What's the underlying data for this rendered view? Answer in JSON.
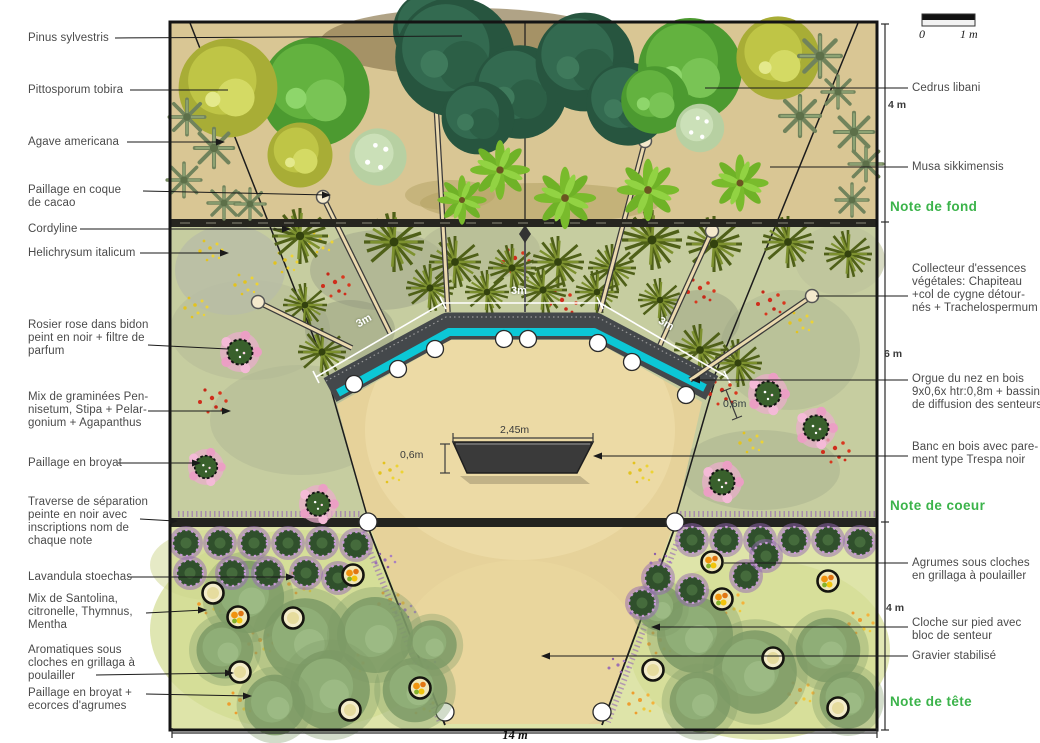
{
  "labels_left": [
    {
      "text": "Pinus sylvestris"
    },
    {
      "text": "Pittosporum tobira"
    },
    {
      "text": "Agave americana"
    },
    {
      "text": "Paillage en coque\nde cacao"
    },
    {
      "text": "Cordyline"
    },
    {
      "text": "Helichrysum italicum"
    },
    {
      "text": "Rosier rose dans bidon\npeint en noir + filtre de\nparfum"
    },
    {
      "text": "Mix de graminées Pen-\nnisetum, Stipa + Pelar-\ngonium + Agapanthus"
    },
    {
      "text": "Paillage en broyat"
    },
    {
      "text": "Traverse de séparation\npeinte en noir avec\ninscriptions nom de\nchaque note"
    },
    {
      "text": "Lavandula stoechas"
    },
    {
      "text": "Mix de Santolina,\ncitronelle, Thymnus,\nMentha"
    },
    {
      "text": "Aromatiques sous\ncloches en grillaga à\npoulailler"
    },
    {
      "text": "Paillage en broyat +\necorces d'agrumes"
    }
  ],
  "labels_right": [
    {
      "text": "Cedrus libani"
    },
    {
      "text": "Musa sikkimensis"
    },
    {
      "text": "Collecteur d'essences\nvégétales: Chapiteau\n+col de cygne détour-\nnés + Trachelospermum"
    },
    {
      "text": "Orgue du nez en bois\n9x0,6x htr:0,8m + bassin\nde diffusion des senteurs"
    },
    {
      "text": "Banc en bois avec pare-\nment type Trespa noir"
    },
    {
      "text": "Agrumes sous cloches\nen grillaga à poulailler"
    },
    {
      "text": "Cloche sur pied avec\nbloc de senteur"
    },
    {
      "text": "Gravier stabilisé"
    }
  ],
  "notes": [
    {
      "text": "Note de fond"
    },
    {
      "text": "Note de coeur"
    },
    {
      "text": "Note de tête"
    }
  ],
  "dims": {
    "depth_top": "4 m",
    "depth_mid": "6 m",
    "depth_bottom": "4 m",
    "width_bottom": "14 m",
    "scene_left": "3m",
    "scene_top": "3m",
    "scene_right": "3m",
    "bench_width": "2,45m",
    "bench_depth": "0,6m",
    "organ_depth": "0,6m"
  },
  "scale_bar": {
    "start": "0",
    "end": "1 m"
  },
  "meta": {
    "note_green": "#3bb34a",
    "water_cyan": "#0cc7d6",
    "sand": "#e6d29a"
  }
}
